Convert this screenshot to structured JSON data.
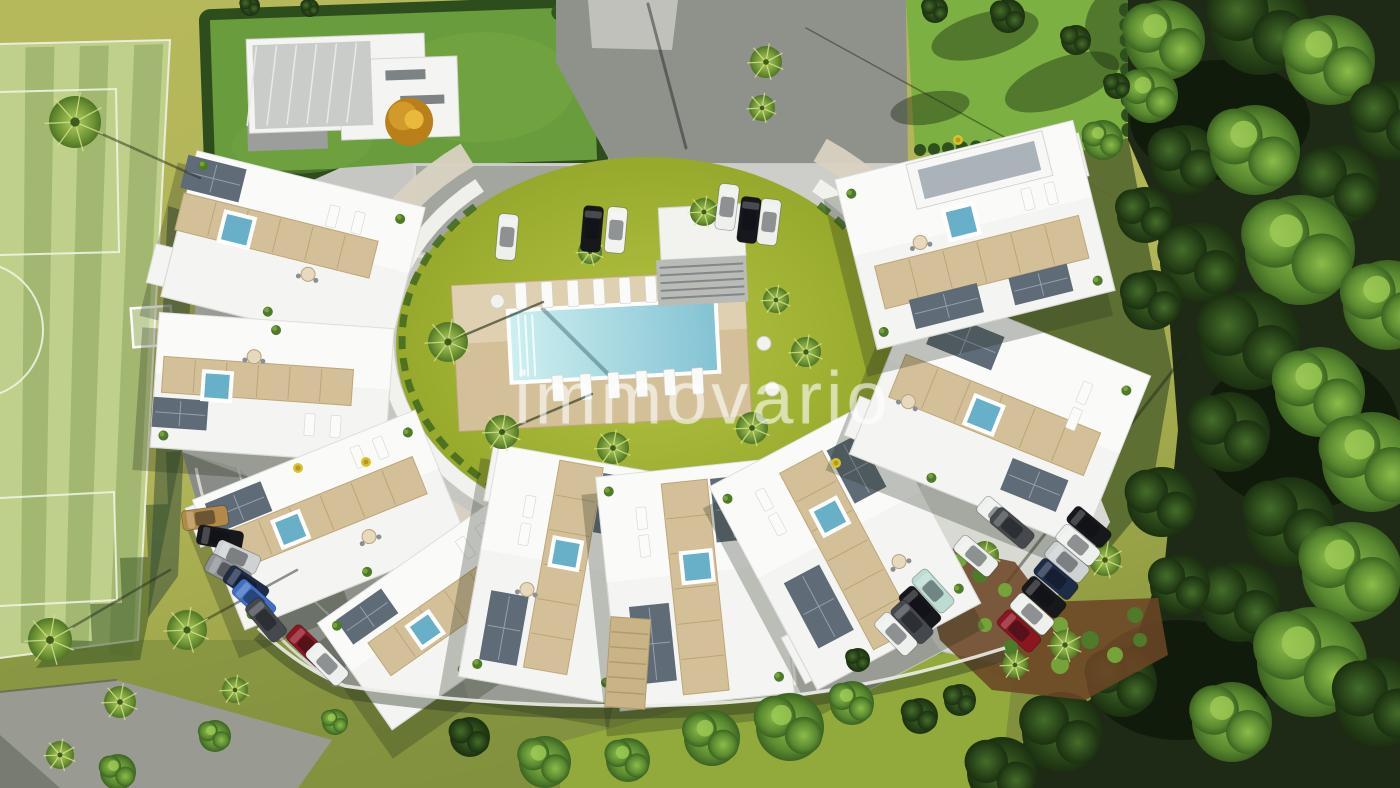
{
  "watermark": {
    "text": "immovario",
    "color": "rgba(255,255,255,0.55)"
  },
  "palette": {
    "ground_light": "#b2b457",
    "ground_dark": "#8d9a40",
    "ground_deep": "#77883a",
    "field": "#bed089",
    "field_stripe": "rgba(100,130,55,0.30)",
    "field_shadow": "rgba(52,80,33,0.5)",
    "line_white": "#f2f5ea",
    "villa_lawn": "#699c3c",
    "hedge": "#2d4d1d",
    "lawn_bright": "#7cb043",
    "forest_base": "#1e2a15",
    "shade_grass": "#5a6c31",
    "asphalt": "#8f918b",
    "concrete_patch": "#c5c6c0",
    "pavement": "#c6c6c2",
    "pavement_light": "#d9d9d4",
    "pavement_mid": "#b6b7b3",
    "path_gray": "#999b93",
    "building": "#f4f5f3",
    "building_edge": "#d9dad6",
    "deck": "#d4c098",
    "deck_dark": "#bfa678",
    "panel": "#5f6b76",
    "panel_line": "#93a1ad",
    "plunge": "#68b0c8",
    "pool_light": "#cdeff0",
    "pool_deep": "#84c3d3",
    "pool_rim": "#ffffff",
    "mulch": "#6b4526",
    "shrub": "#4e7a2a",
    "shrub_hi": "#76a23a",
    "flower": "#d9c22e",
    "wall": "#ecece8",
    "pergola": "#c9b488",
    "car": {
      "white": "#eef0ee",
      "white_s": "#f2f3f1",
      "black": "#17181c",
      "tan": "#b3894a",
      "silver": "#cfd2d2",
      "gray": "#8f9296",
      "navy": "#1f2c48",
      "blue": "#3f6fc4",
      "dkgray": "#45484d",
      "red": "#8c1520",
      "mint": "#bcdcd2"
    }
  },
  "scene": {
    "courtyard": {
      "cx": 648,
      "cy": 345,
      "rx": 252,
      "ry": 188
    },
    "ring": {
      "cx": 648,
      "cy": 340,
      "bands": [
        {
          "rx": 300,
          "ry": 232,
          "w": 26,
          "kind": "terrace",
          "a0": -55,
          "a1": 235
        },
        {
          "rx": 262,
          "ry": 202,
          "w": 15,
          "kind": "white",
          "a0": -50,
          "a1": 232
        },
        {
          "rx": 246,
          "ry": 188,
          "w": 7,
          "kind": "planter",
          "a0": -46,
          "a1": 228,
          "dash": "13 9"
        }
      ]
    },
    "pool": {
      "rot": -3,
      "deck": [
        455,
        278,
        293,
        146
      ],
      "rim": [
        512,
        308,
        204,
        68
      ],
      "lg_top": {
        "x0": 524,
        "y": 292,
        "n": 7,
        "dx": 26
      },
      "lg_bot": {
        "x0": 556,
        "y": 386,
        "n": 6,
        "dx": 28
      },
      "tables": [
        [
          500,
          296
        ],
        [
          764,
          352
        ],
        [
          770,
          398
        ]
      ]
    },
    "stairs": {
      "canopy": [
        660,
        206,
        85,
        52
      ],
      "steps": [
        655,
        258,
        90,
        46
      ],
      "rot": -3
    },
    "buildings": [
      {
        "cx": 293,
        "cy": 252,
        "w": 235,
        "h": 150,
        "rot": 14,
        "deck": [
          -20,
          -12,
          200,
          38
        ],
        "panels": [
          [
            -95,
            -52,
            60,
            34
          ]
        ],
        "pool": [
          -60,
          -8,
          26
        ],
        "lg": [
          [
            30,
            -44
          ],
          [
            56,
            -44
          ]
        ],
        "shrubs": [
          [
            -108,
            -62
          ],
          [
            -10,
            64
          ],
          [
            96,
            -58
          ]
        ],
        "extra": [
          -60,
          45,
          150,
          40
        ],
        "table": [
          20,
          18
        ]
      },
      {
        "cx": 272,
        "cy": 388,
        "w": 235,
        "h": 135,
        "rot": 4,
        "deck": [
          -15,
          -6,
          190,
          36
        ],
        "panels": [
          [
            -90,
            32,
            55,
            30
          ]
        ],
        "pool": [
          -55,
          2,
          24
        ],
        "lg": [
          [
            40,
            34
          ],
          [
            66,
            34
          ]
        ],
        "shrubs": [
          [
            -105,
            55
          ],
          [
            0,
            -58
          ],
          [
            100,
            52
          ]
        ],
        "extra": [
          55,
          -42,
          120,
          44
        ],
        "table": [
          -20,
          -30
        ]
      },
      {
        "cx": 330,
        "cy": 520,
        "w": 240,
        "h": 140,
        "rot": -22,
        "deck": [
          0,
          -8,
          200,
          40
        ],
        "panels": [
          [
            -80,
            -46,
            60,
            32
          ]
        ],
        "pool": [
          -40,
          -6,
          24
        ],
        "lg": [
          [
            50,
            -48
          ],
          [
            74,
            -48
          ]
        ],
        "shrubs": [
          [
            -108,
            58
          ],
          [
            15,
            62
          ],
          [
            105,
            -52
          ]
        ],
        "extra": [
          -70,
          -44,
          120,
          42
        ],
        "table": [
          30,
          30
        ]
      },
      {
        "cx": 447,
        "cy": 612,
        "w": 225,
        "h": 130,
        "rot": -35,
        "deck": [
          10,
          0,
          185,
          40
        ],
        "panels": [
          [
            -68,
            -42,
            55,
            30
          ]
        ],
        "pool": [
          -28,
          2,
          22
        ],
        "lg": [
          [
            52,
            -42
          ],
          [
            76,
            -42
          ]
        ],
        "shrubs": [
          [
            -98,
            -52
          ],
          [
            -20,
            56
          ],
          [
            88,
            48
          ]
        ],
        "extra": [
          60,
          42,
          100,
          38
        ]
      },
      {
        "cx": 560,
        "cy": 575,
        "w": 165,
        "h": 235,
        "rot": 10,
        "deck": [
          2,
          -8,
          44,
          210
        ],
        "panels": [
          [
            -46,
            62,
            38,
            70
          ],
          [
            42,
            -78,
            34,
            60
          ]
        ],
        "pool": [
          2,
          -22,
          24
        ],
        "lg": [
          [
            -42,
            -62
          ],
          [
            -42,
            -34
          ]
        ],
        "shrubs": [
          [
            -66,
            102
          ],
          [
            64,
            98
          ],
          [
            66,
            -102
          ]
        ],
        "extra": [
          -48,
          -88,
          80,
          56
        ],
        "table": [
          -30,
          20
        ]
      },
      {
        "cx": 695,
        "cy": 585,
        "w": 175,
        "h": 235,
        "rot": -6,
        "deck": [
          0,
          2,
          46,
          212
        ],
        "panels": [
          [
            -48,
            54,
            40,
            78
          ],
          [
            44,
            -72,
            36,
            64
          ]
        ],
        "pool": [
          4,
          -18,
          26
        ],
        "lg": [
          [
            -46,
            -72
          ],
          [
            -46,
            -44
          ]
        ],
        "shrubs": [
          [
            -76,
            -102
          ],
          [
            74,
            100
          ],
          [
            -72,
            62
          ]
        ],
        "extra": [
          52,
          84,
          78,
          52
        ]
      },
      {
        "cx": 845,
        "cy": 545,
        "w": 185,
        "h": 230,
        "rot": -28,
        "deck": [
          0,
          6,
          48,
          200
        ],
        "panels": [
          [
            -52,
            42,
            40,
            74
          ],
          [
            46,
            -62,
            36,
            60
          ]
        ],
        "pool": [
          0,
          -32,
          24
        ],
        "lg": [
          [
            -50,
            -78
          ],
          [
            -50,
            -50
          ]
        ],
        "shrubs": [
          [
            -82,
            -96
          ],
          [
            80,
            92
          ],
          [
            76,
            -92
          ]
        ],
        "extra": [
          -56,
          78,
          88,
          52
        ],
        "table": [
          40,
          40
        ]
      },
      {
        "cx": 1000,
        "cy": 415,
        "w": 250,
        "h": 185,
        "rot": 22,
        "deck": [
          -5,
          2,
          210,
          46
        ],
        "panels": [
          [
            -60,
            -56,
            70,
            36
          ],
          [
            58,
            52,
            60,
            34
          ]
        ],
        "pool": [
          -15,
          6,
          26
        ],
        "lg": [
          [
            70,
            -52
          ],
          [
            70,
            -24
          ]
        ],
        "shrubs": [
          [
            -112,
            -78
          ],
          [
            108,
            -70
          ],
          [
            -40,
            84
          ]
        ],
        "extra": [
          -72,
          56,
          130,
          42
        ],
        "table": [
          -90,
          22
        ]
      },
      {
        "cx": 975,
        "cy": 235,
        "w": 245,
        "h": 175,
        "rot": -14,
        "deck": [
          0,
          28,
          210,
          44
        ],
        "panels": [
          [
            -45,
            62,
            70,
            30
          ],
          [
            52,
            64,
            60,
            28
          ]
        ],
        "pool": [
          -10,
          -16,
          26
        ],
        "lg": [
          [
            60,
            -22
          ],
          [
            84,
            -22
          ]
        ],
        "shrubs": [
          [
            -112,
            72
          ],
          [
            -110,
            -70
          ],
          [
            108,
            74
          ]
        ],
        "extra": [
          70,
          -52,
          110,
          44
        ],
        "ph": [
          20,
          -62,
          140,
          46
        ],
        "table": [
          -55,
          -6
        ]
      }
    ],
    "cars": {
      "top": [
        [
          507,
          237,
          95,
          "white"
        ],
        [
          592,
          229,
          95,
          "black"
        ],
        [
          616,
          230,
          95,
          "white_s"
        ],
        [
          727,
          207,
          97,
          "white"
        ],
        [
          749,
          220,
          97,
          "black"
        ],
        [
          769,
          222,
          97,
          "white"
        ]
      ],
      "bl": [
        [
          205,
          518,
          -8,
          "tan"
        ],
        [
          220,
          538,
          10,
          "black"
        ],
        [
          237,
          557,
          24,
          "silver"
        ],
        [
          228,
          572,
          28,
          "gray"
        ],
        [
          246,
          585,
          34,
          "navy"
        ],
        [
          254,
          600,
          42,
          "blue"
        ],
        [
          266,
          620,
          50,
          "dkgray"
        ],
        [
          308,
          646,
          44,
          "red"
        ],
        [
          327,
          664,
          46,
          "white"
        ]
      ],
      "br": [
        [
          1089,
          527,
          40,
          "black"
        ],
        [
          1078,
          545,
          40,
          "white"
        ],
        [
          1067,
          562,
          40,
          "silver"
        ],
        [
          1056,
          579,
          40,
          "navy"
        ],
        [
          1044,
          597,
          41,
          "black"
        ],
        [
          1032,
          614,
          42,
          "white"
        ],
        [
          1019,
          631,
          43,
          "red"
        ],
        [
          999,
          517,
          40,
          "white"
        ],
        [
          1012,
          528,
          40,
          "dkgray"
        ],
        [
          976,
          556,
          40,
          "white"
        ],
        [
          933,
          591,
          48,
          "mint"
        ],
        [
          920,
          608,
          48,
          "black"
        ],
        [
          912,
          622,
          47,
          "dkgray"
        ],
        [
          896,
          634,
          46,
          "white"
        ]
      ]
    },
    "trees": {
      "palms": [
        [
          75,
          122,
          26,
          [
            125,
            56
          ]
        ],
        [
          766,
          62,
          16
        ],
        [
          762,
          108,
          13
        ],
        [
          448,
          342,
          20,
          [
            95,
            -40
          ]
        ],
        [
          502,
          432,
          17,
          [
            90,
            -38
          ]
        ],
        [
          613,
          448,
          16
        ],
        [
          752,
          428,
          16
        ],
        [
          806,
          352,
          15
        ],
        [
          776,
          300,
          13
        ],
        [
          704,
          212,
          14
        ],
        [
          590,
          252,
          12
        ],
        [
          50,
          640,
          22,
          [
            120,
            -70
          ]
        ],
        [
          187,
          630,
          20,
          [
            110,
            -60
          ]
        ],
        [
          120,
          702,
          16
        ],
        [
          985,
          555,
          14
        ],
        [
          1105,
          560,
          16
        ],
        [
          1065,
          645,
          15
        ],
        [
          1015,
          665,
          13
        ],
        [
          235,
          690,
          13
        ],
        [
          60,
          755,
          14
        ]
      ],
      "leafy": [
        [
          545,
          762,
          26
        ],
        [
          628,
          760,
          22
        ],
        [
          712,
          738,
          28
        ],
        [
          790,
          727,
          34
        ],
        [
          852,
          703,
          22
        ],
        [
          215,
          736,
          16
        ],
        [
          335,
          722,
          13
        ],
        [
          118,
          772,
          18
        ],
        [
          1150,
          95,
          28
        ],
        [
          1103,
          140,
          20
        ]
      ],
      "dark": [
        [
          470,
          737,
          20
        ],
        [
          920,
          716,
          18
        ],
        [
          858,
          660,
          12
        ],
        [
          250,
          6,
          10
        ],
        [
          310,
          8,
          9
        ],
        [
          935,
          10,
          13
        ],
        [
          1008,
          16,
          17
        ],
        [
          1076,
          40,
          15
        ],
        [
          1117,
          86,
          13
        ],
        [
          960,
          700,
          16
        ]
      ],
      "flowers": [
        [
          366,
          462
        ],
        [
          958,
          140
        ],
        [
          836,
          463
        ],
        [
          298,
          468
        ]
      ],
      "forest": [
        [
          1165,
          40,
          40,
          "l"
        ],
        [
          1260,
          25,
          50,
          "d"
        ],
        [
          1330,
          60,
          45,
          "l"
        ],
        [
          1392,
          120,
          40,
          "d"
        ],
        [
          1185,
          160,
          35,
          "d"
        ],
        [
          1255,
          150,
          45,
          "l"
        ],
        [
          1340,
          185,
          40,
          "d"
        ],
        [
          1300,
          250,
          55,
          "l"
        ],
        [
          1200,
          262,
          40,
          "d"
        ],
        [
          1388,
          305,
          45,
          "l"
        ],
        [
          1250,
          340,
          50,
          "d"
        ],
        [
          1320,
          392,
          45,
          "l"
        ],
        [
          1230,
          432,
          40,
          "d"
        ],
        [
          1372,
          462,
          50,
          "l"
        ],
        [
          1290,
          522,
          45,
          "d"
        ],
        [
          1352,
          572,
          50,
          "l"
        ],
        [
          1240,
          602,
          40,
          "d"
        ],
        [
          1312,
          662,
          55,
          "l"
        ],
        [
          1380,
          702,
          45,
          "d"
        ],
        [
          1232,
          722,
          40,
          "l"
        ],
        [
          1152,
          300,
          30,
          "d"
        ],
        [
          1162,
          502,
          35,
          "d"
        ],
        [
          1122,
          682,
          35,
          "d"
        ],
        [
          1062,
          732,
          40,
          "d"
        ],
        [
          1002,
          772,
          35,
          "d"
        ],
        [
          1145,
          215,
          28,
          "d"
        ],
        [
          1180,
          585,
          30,
          "d"
        ]
      ]
    },
    "beds": {
      "greens": [
        [
          960,
          560,
          7
        ],
        [
          980,
          575,
          8
        ],
        [
          1005,
          590,
          7
        ],
        [
          1030,
          610,
          9
        ],
        [
          1060,
          625,
          8
        ],
        [
          1090,
          640,
          9
        ],
        [
          1115,
          655,
          8
        ],
        [
          1140,
          640,
          7
        ],
        [
          1060,
          665,
          9
        ],
        [
          1010,
          648,
          8
        ],
        [
          985,
          625,
          7
        ],
        [
          1135,
          615,
          8
        ]
      ]
    }
  }
}
